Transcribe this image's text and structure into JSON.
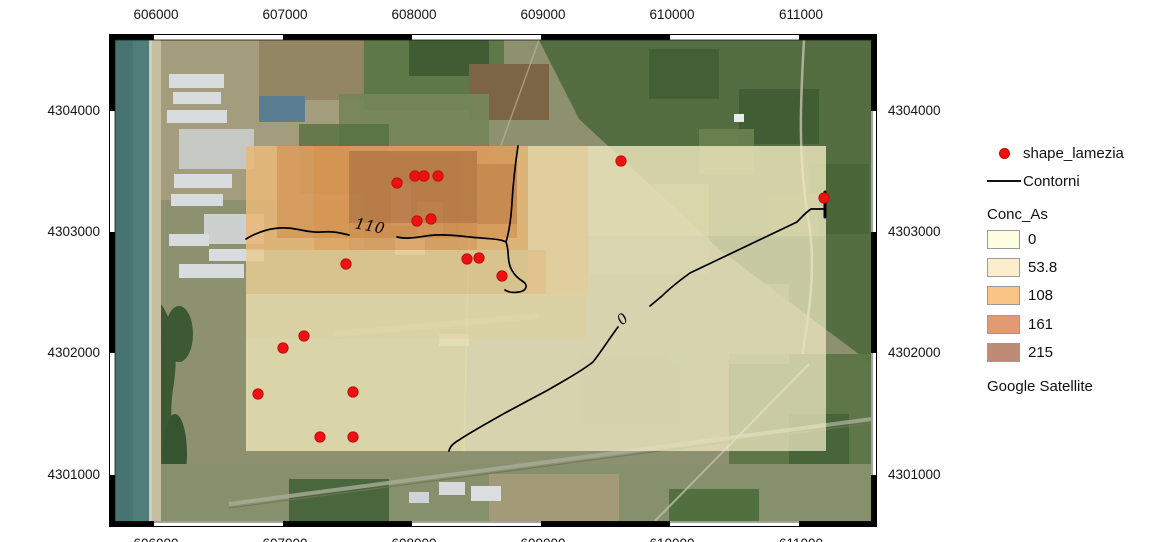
{
  "axes": {
    "top": [
      "606000",
      "607000",
      "608000",
      "609000",
      "610000",
      "611000"
    ],
    "bottom": [
      "606000",
      "607000",
      "608000",
      "609000",
      "610000",
      "611000"
    ],
    "left": [
      "4304000",
      "4303000",
      "4302000",
      "4301000"
    ],
    "right": [
      "4304000",
      "4303000",
      "4302000",
      "4301000"
    ]
  },
  "map": {
    "contour_labels": {
      "c110": "110",
      "c0": "0"
    },
    "sample_point_count": "18"
  },
  "legend": {
    "point_item": {
      "label": "shape_lamezia",
      "color": "#ee1111"
    },
    "line_item": {
      "label": "Contorni",
      "color": "#000000"
    },
    "group_title": "Conc_As",
    "classes": [
      {
        "label": "0",
        "color": "#fdfde2"
      },
      {
        "label": "53.8",
        "color": "#fcedcc"
      },
      {
        "label": "108",
        "color": "#f8c585"
      },
      {
        "label": "161",
        "color": "#e19b74"
      },
      {
        "label": "215",
        "color": "#bf8b75"
      }
    ],
    "basemap_label": "Google Satellite"
  },
  "colors": {
    "sample_point": "#ee1111",
    "contour": "#000000",
    "sea": "#4e7d7a"
  }
}
